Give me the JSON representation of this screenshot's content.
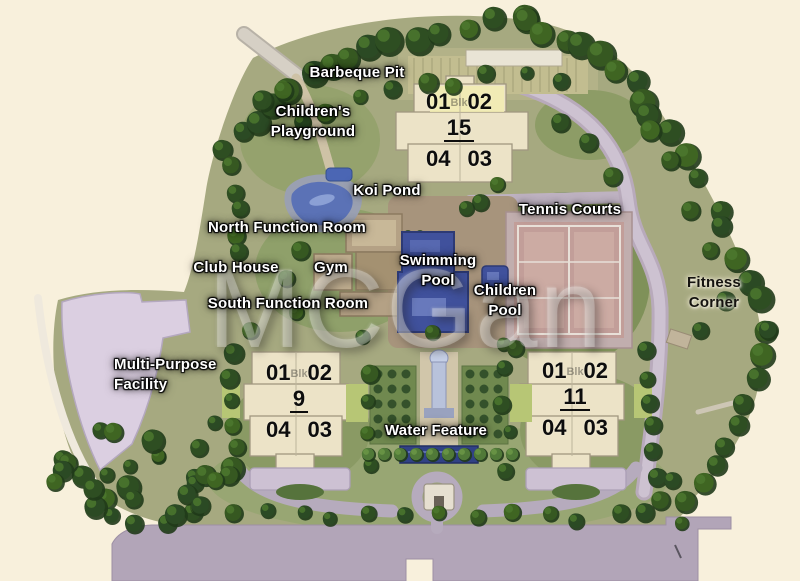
{
  "map": {
    "watermark": "MCGan",
    "colors": {
      "background": "#f8f0db",
      "site_green": "#a6a97e",
      "tree_canopy": "#2d4f20",
      "road_lavender": "#b9abbe",
      "water_blue": "#3f51a0",
      "court_pink": "#c49e98",
      "building_cream": "#ece3c6"
    },
    "labels": [
      {
        "id": "barbeque-pit",
        "lines": [
          "Barbeque Pit"
        ],
        "x": 357,
        "y": 63,
        "style": "light"
      },
      {
        "id": "childrens-playground",
        "lines": [
          "Children's",
          "Playground"
        ],
        "x": 313,
        "y": 102,
        "style": "light"
      },
      {
        "id": "koi-pond",
        "lines": [
          "Koi Pond"
        ],
        "x": 387,
        "y": 181,
        "style": "light"
      },
      {
        "id": "north-function-room",
        "lines": [
          "North Function Room"
        ],
        "x": 287,
        "y": 218,
        "style": "light"
      },
      {
        "id": "club-house",
        "lines": [
          "Club House"
        ],
        "x": 236,
        "y": 258,
        "style": "light"
      },
      {
        "id": "gym",
        "lines": [
          "Gym"
        ],
        "x": 331,
        "y": 258,
        "style": "light"
      },
      {
        "id": "swimming-pool",
        "lines": [
          "Swimming",
          "Pool"
        ],
        "x": 438,
        "y": 251,
        "style": "light"
      },
      {
        "id": "tennis-courts",
        "lines": [
          "Tennis Courts"
        ],
        "x": 570,
        "y": 200,
        "style": "light"
      },
      {
        "id": "children-pool",
        "lines": [
          "Children",
          "Pool"
        ],
        "x": 505,
        "y": 281,
        "style": "light"
      },
      {
        "id": "south-function-room",
        "lines": [
          "South Function Room"
        ],
        "x": 288,
        "y": 294,
        "style": "light"
      },
      {
        "id": "fitness-corner",
        "lines": [
          "Fitness",
          "Corner"
        ],
        "x": 714,
        "y": 273,
        "style": "dark"
      },
      {
        "id": "multi-purpose-facility",
        "lines": [
          "Multi-Purpose",
          "Facility"
        ],
        "x": 114,
        "y": 355,
        "style": "light",
        "align": "left"
      },
      {
        "id": "water-feature",
        "lines": [
          "Water Feature"
        ],
        "x": 436,
        "y": 421,
        "style": "light"
      }
    ],
    "blocks": [
      {
        "id": "block-15",
        "number": "15",
        "ghost": "Blk",
        "top_units": [
          "01",
          "02"
        ],
        "bottom_units": [
          "04",
          "03"
        ],
        "cx": 459,
        "y": 90
      },
      {
        "id": "block-9",
        "number": "9",
        "ghost": "Blk",
        "top_units": [
          "01",
          "02"
        ],
        "bottom_units": [
          "04",
          "03"
        ],
        "cx": 299,
        "y": 361
      },
      {
        "id": "block-11",
        "number": "11",
        "ghost": "Blk",
        "top_units": [
          "01",
          "02"
        ],
        "bottom_units": [
          "04",
          "03"
        ],
        "cx": 575,
        "y": 359
      }
    ]
  }
}
